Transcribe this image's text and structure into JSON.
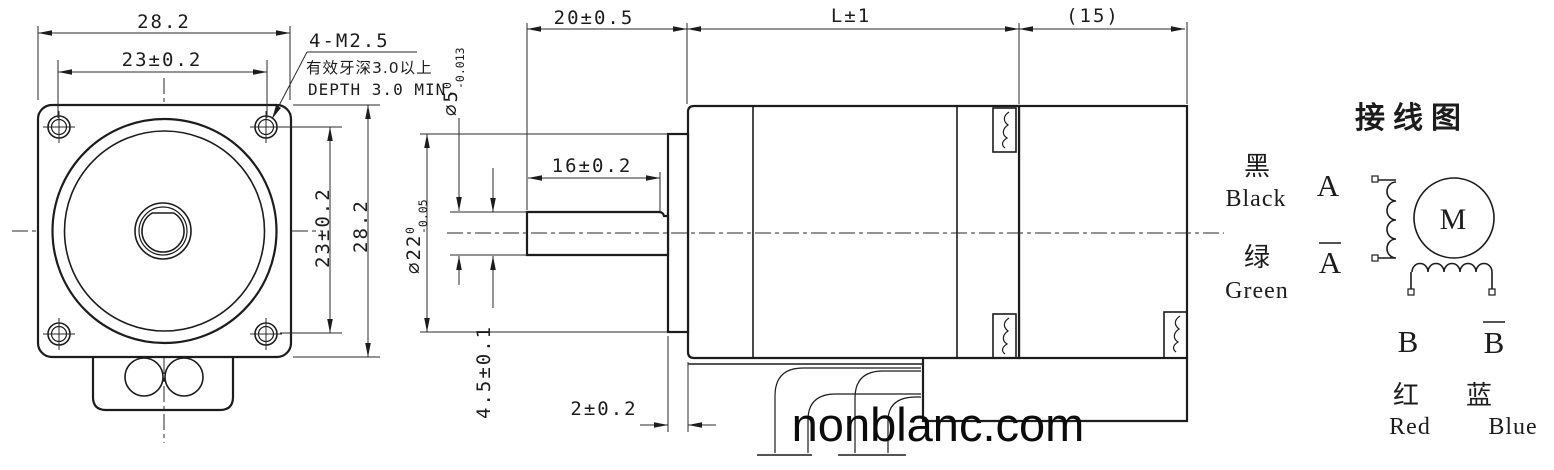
{
  "watermark": "nonblanc.com",
  "front_view": {
    "dim_top_outer": "28.2",
    "dim_top_holes": "23±0.2",
    "dim_right_holes": "23±0.2",
    "dim_right_outer": "28.2",
    "thread_callout": "4-M2.5",
    "thread_note_cn": "有效牙深3.0以上",
    "thread_note_en": "DEPTH 3.0 MIN."
  },
  "side_view": {
    "dim_shaft_length": "20±0.5",
    "dim_body_length": "L±1",
    "dim_rear_length": "(15)",
    "dim_flat_length": "16±0.2",
    "shaft_dia": {
      "value": "⌀5",
      "tol_upper": "0",
      "tol_lower": "-0.013"
    },
    "boss_dia": {
      "value": "⌀22",
      "tol_upper": "0",
      "tol_lower": "-0.05"
    },
    "dim_flat_height": "4.5±0.1",
    "dim_boss_thickness": "2±0.2"
  },
  "wiring": {
    "title": "接线图",
    "motor_label": "M",
    "phase_a": {
      "terminal": "A",
      "terminal_bar": "A",
      "wire1_cn": "黑",
      "wire1_en": "Black",
      "wire2_cn": "绿",
      "wire2_en": "Green"
    },
    "phase_b": {
      "terminal": "B",
      "terminal_bar": "B",
      "wire1_cn": "红",
      "wire1_en": "Red",
      "wire2_cn": "蓝",
      "wire2_en": "Blue"
    }
  }
}
